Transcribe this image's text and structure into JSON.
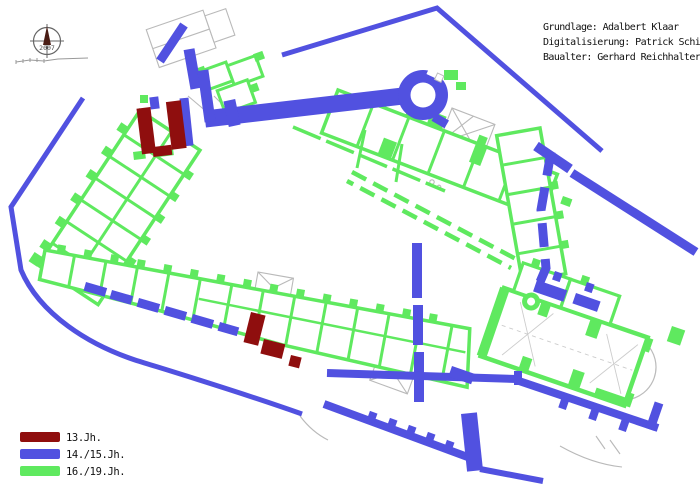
{
  "page": {
    "width": 700,
    "height": 486,
    "background": "#ffffff"
  },
  "attribution": {
    "line1": "Grundlage: Adalbert Klaar",
    "line2": "Digitalisierung: Patrick Schicht",
    "line3": "Baualter: Gerhard Reichhalter"
  },
  "compass": {
    "year": "2007"
  },
  "legend": {
    "items": [
      {
        "label": "13.Jh.",
        "color": "#8F0E0E"
      },
      {
        "label": "14./15.Jh.",
        "color": "#5151E0"
      },
      {
        "label": "16./19.Jh.",
        "color": "#5FE95F"
      }
    ]
  },
  "colors": {
    "period_13": "#8F0E0E",
    "period_14_15": "#5151E0",
    "period_16_19": "#5FE95F",
    "outline_gray": "#B9B9B9",
    "detail_gray": "#9A9A9A",
    "text": "#111111"
  }
}
